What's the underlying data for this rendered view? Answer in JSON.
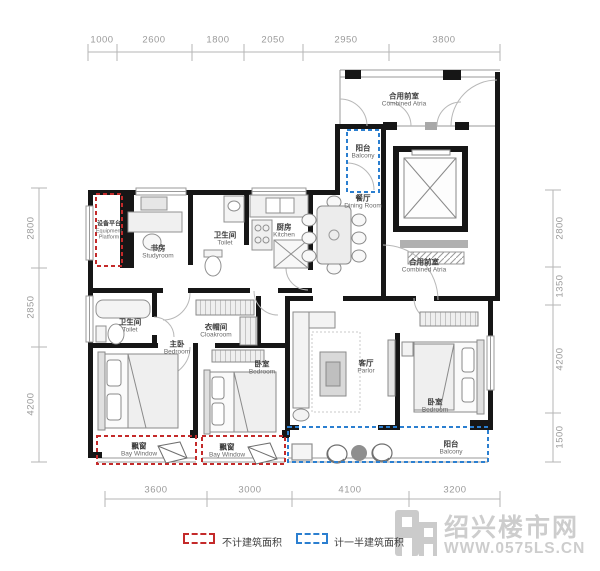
{
  "dimensions": {
    "top": [
      "1000",
      "2600",
      "1800",
      "2050",
      "2950",
      "3800"
    ],
    "bottom": [
      "3600",
      "3000",
      "4100",
      "3200"
    ],
    "left": [
      "2800",
      "2850",
      "4200"
    ],
    "right": [
      "2800",
      "1350",
      "4200",
      "1500"
    ]
  },
  "rooms": {
    "equipment_platform": {
      "cn": "设备平台",
      "en": "Equipment Platform"
    },
    "studyroom": {
      "cn": "书房",
      "en": "Studyroom"
    },
    "toilet_1": {
      "cn": "卫生间",
      "en": "Toilet"
    },
    "kitchen": {
      "cn": "厨房",
      "en": "Kitchen"
    },
    "balcony_top": {
      "cn": "阳台",
      "en": "Balcony"
    },
    "dining_room": {
      "cn": "餐厅",
      "en": "Dining Room"
    },
    "combined_atria_top": {
      "cn": "合用前室",
      "en": "Combined Atria"
    },
    "combined_atria_right": {
      "cn": "合用前室",
      "en": "Combined Atria"
    },
    "toilet_2": {
      "cn": "卫生间",
      "en": "Toilet"
    },
    "cloakroom": {
      "cn": "衣帽间",
      "en": "Cloakroom"
    },
    "master_bedroom": {
      "cn": "主卧",
      "en": "Bedroom"
    },
    "bedroom_2": {
      "cn": "卧室",
      "en": "Bedroom"
    },
    "parlor": {
      "cn": "客厅",
      "en": "Parlor"
    },
    "bedroom_3": {
      "cn": "卧室",
      "en": "Bedroom"
    },
    "bay_window_1": {
      "cn": "飘窗",
      "en": "Bay Window"
    },
    "bay_window_2": {
      "cn": "飘窗",
      "en": "Bay Window"
    },
    "balcony_bottom": {
      "cn": "阳台",
      "en": "Balcony"
    }
  },
  "legend": {
    "no_area_label": "不计建筑面积",
    "half_area_label": "计一半建筑面积"
  },
  "watermark": {
    "site_name": "绍兴楼市网",
    "site_url": "WWW.0575LS.CN"
  },
  "colors": {
    "wall": "#161616",
    "excluded_area_dashed": "#c42a2a",
    "half_area_dashed": "#2b7fd0",
    "dimension_gray": "#9a9a9a",
    "watermark_gray": "#cdcdcd"
  }
}
